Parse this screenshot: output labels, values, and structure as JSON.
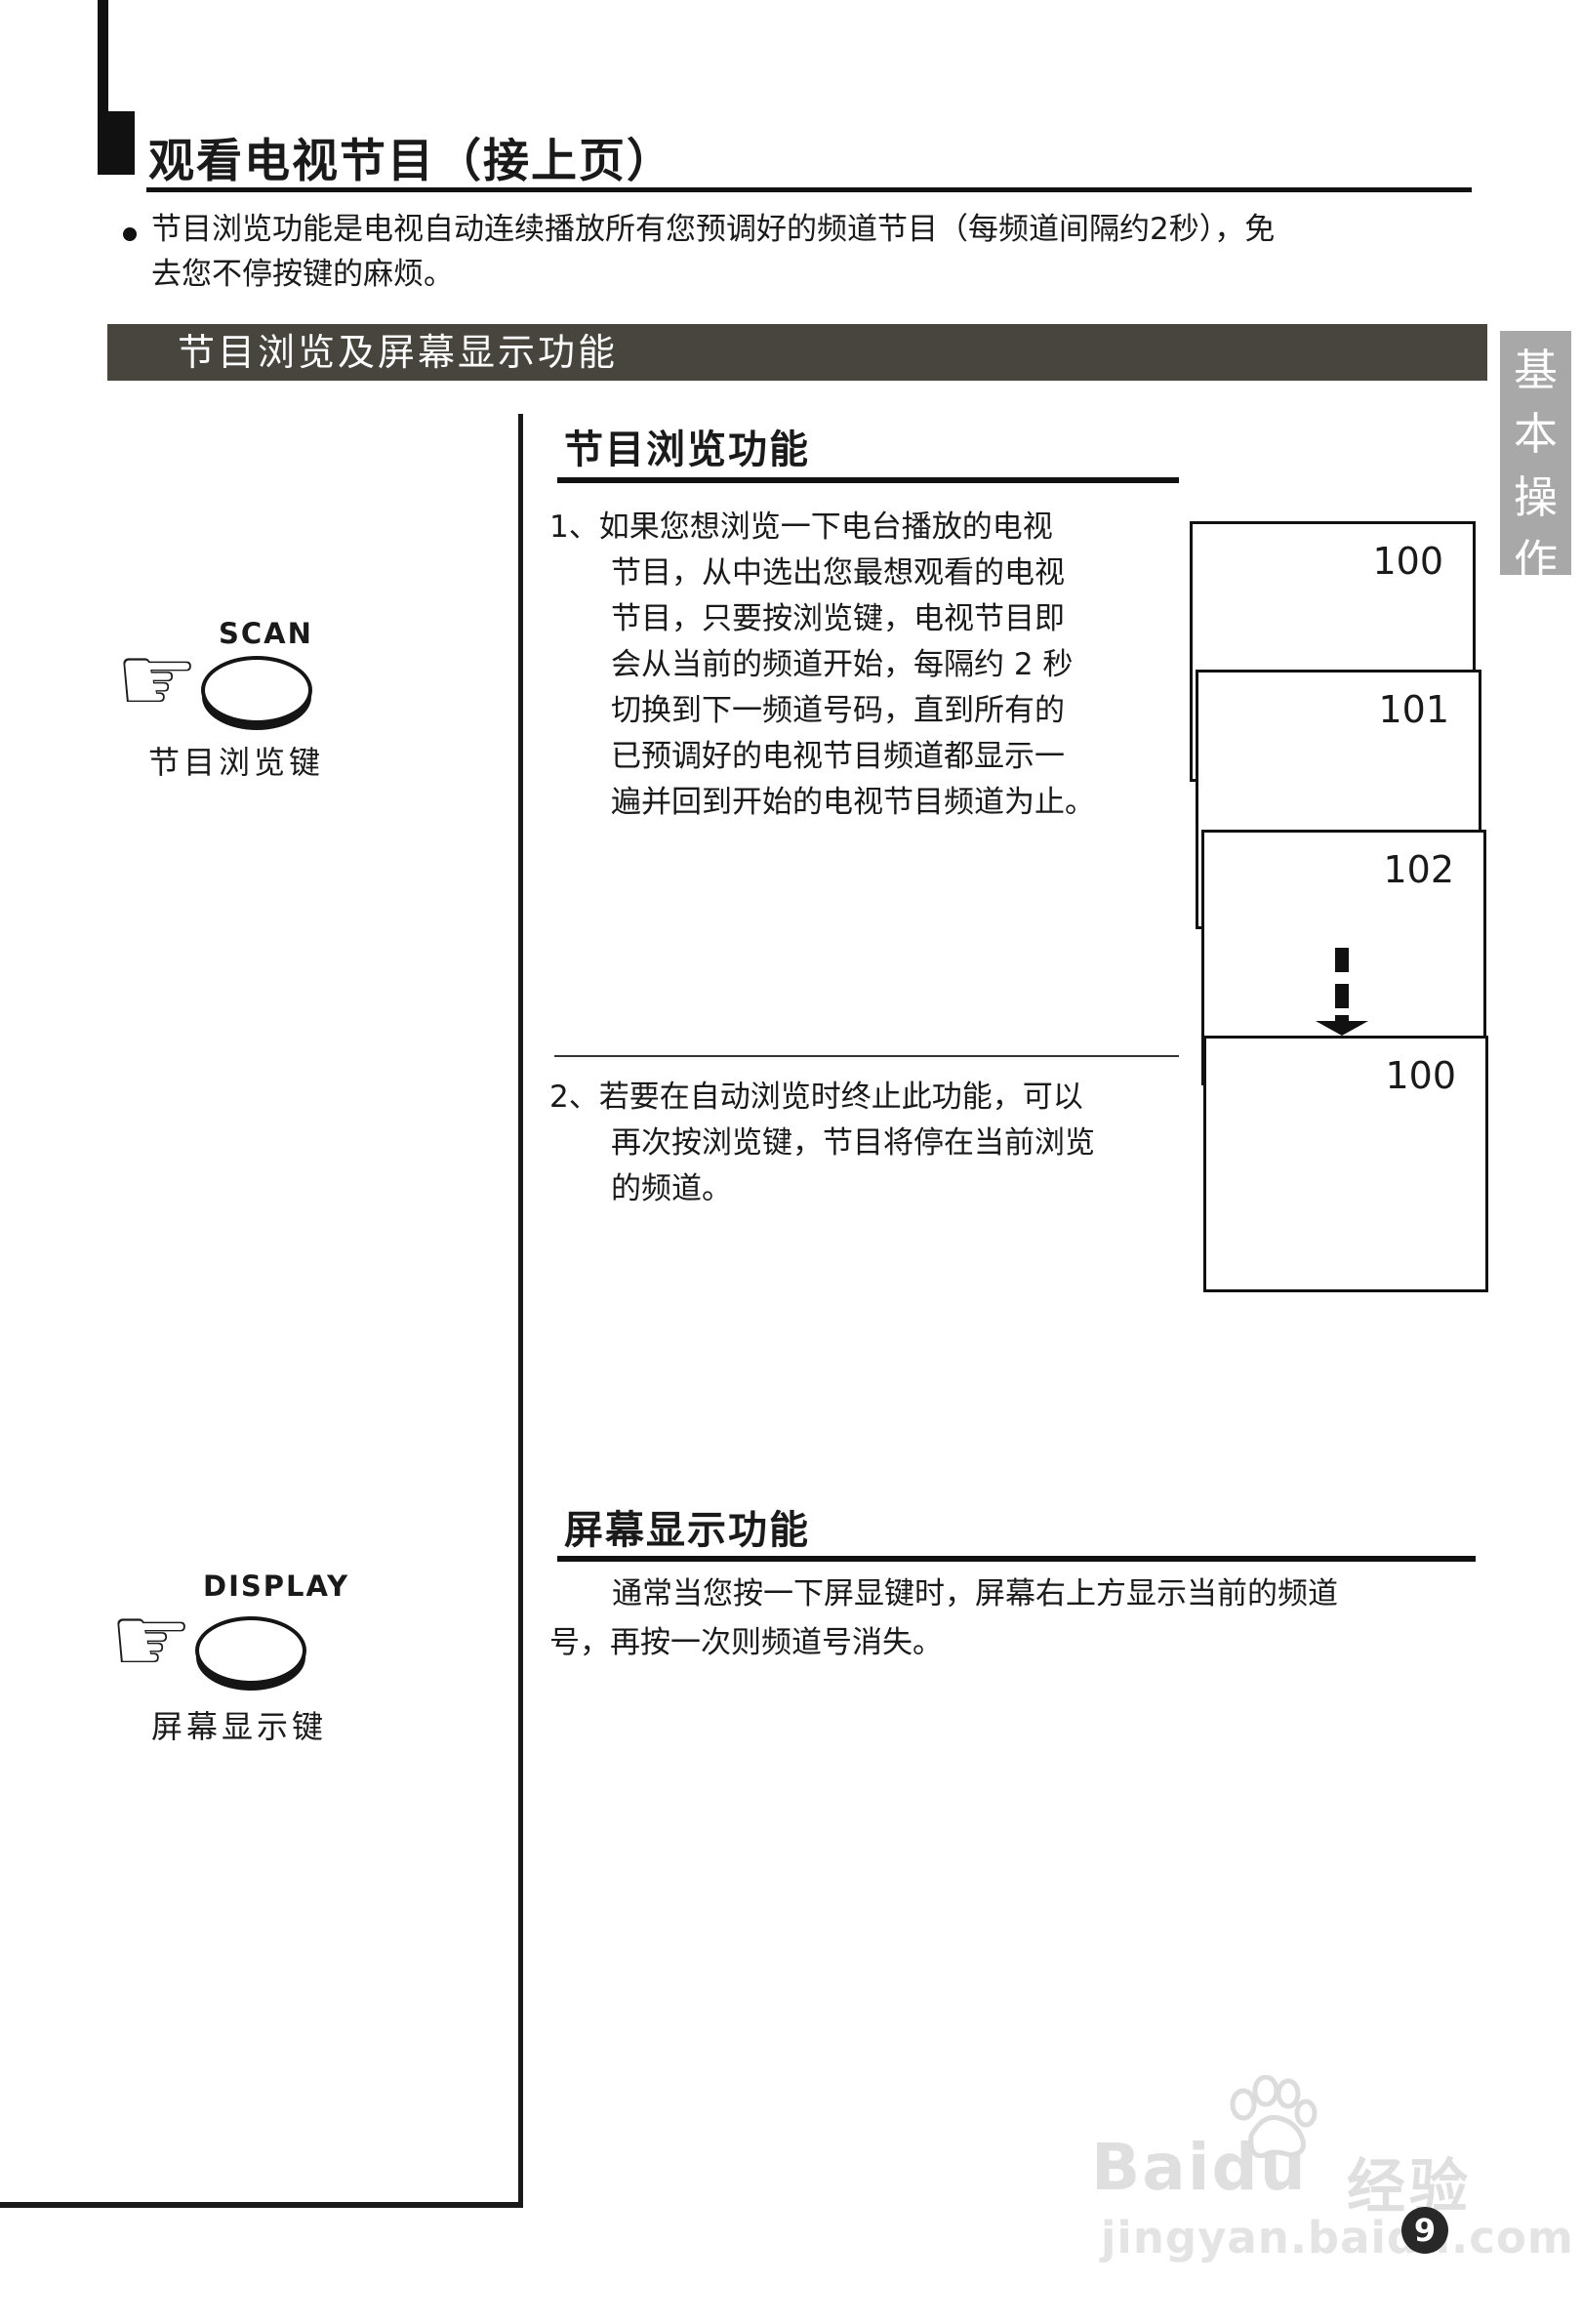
{
  "page": {
    "title": "观看电视节目（接上页）",
    "intro_bullet": {
      "line1": "节目浏览功能是电视自动连续播放所有您预调好的频道节目（每频道间隔约2秒），免",
      "line2": "去您不停按键的麻烦。"
    },
    "section_bar": "节目浏览及屏幕显示功能",
    "side_tab": {
      "chars": [
        "基",
        "本",
        "操",
        "作"
      ]
    },
    "page_number": "9"
  },
  "icons": {
    "pointing_hand": "☞"
  },
  "scan_group": {
    "button_label": "SCAN",
    "caption": "节目浏览键"
  },
  "display_group": {
    "button_label": "DISPLAY",
    "caption": "屏幕显示键"
  },
  "browse_section": {
    "heading": "节目浏览功能",
    "step1_lines": [
      "1、如果您想浏览一下电台播放的电视",
      "节目，从中选出您最想观看的电视",
      "节目，只要按浏览键，电视节目即",
      "会从当前的频道开始，每隔约 2 秒",
      "切换到下一频道号码，直到所有的",
      "已预调好的电视节目频道都显示一",
      "遍并回到开始的电视节目频道为止。"
    ],
    "step2_lines": [
      "2、若要在自动浏览时终止此功能，可以",
      "再次按浏览键，节目将停在当前浏览",
      "的频道。"
    ]
  },
  "screens": {
    "channels": [
      "100",
      "101",
      "102",
      "100"
    ]
  },
  "display_section": {
    "heading": "屏幕显示功能",
    "para_lines": [
      "通常当您按一下屏显键时，屏幕右上方显示当前的频道",
      "号，再按一次则频道号消失。"
    ]
  },
  "watermark": {
    "brand": "Baidu",
    "brand_cn": "经验",
    "url": "jingyan.baidu.com"
  }
}
